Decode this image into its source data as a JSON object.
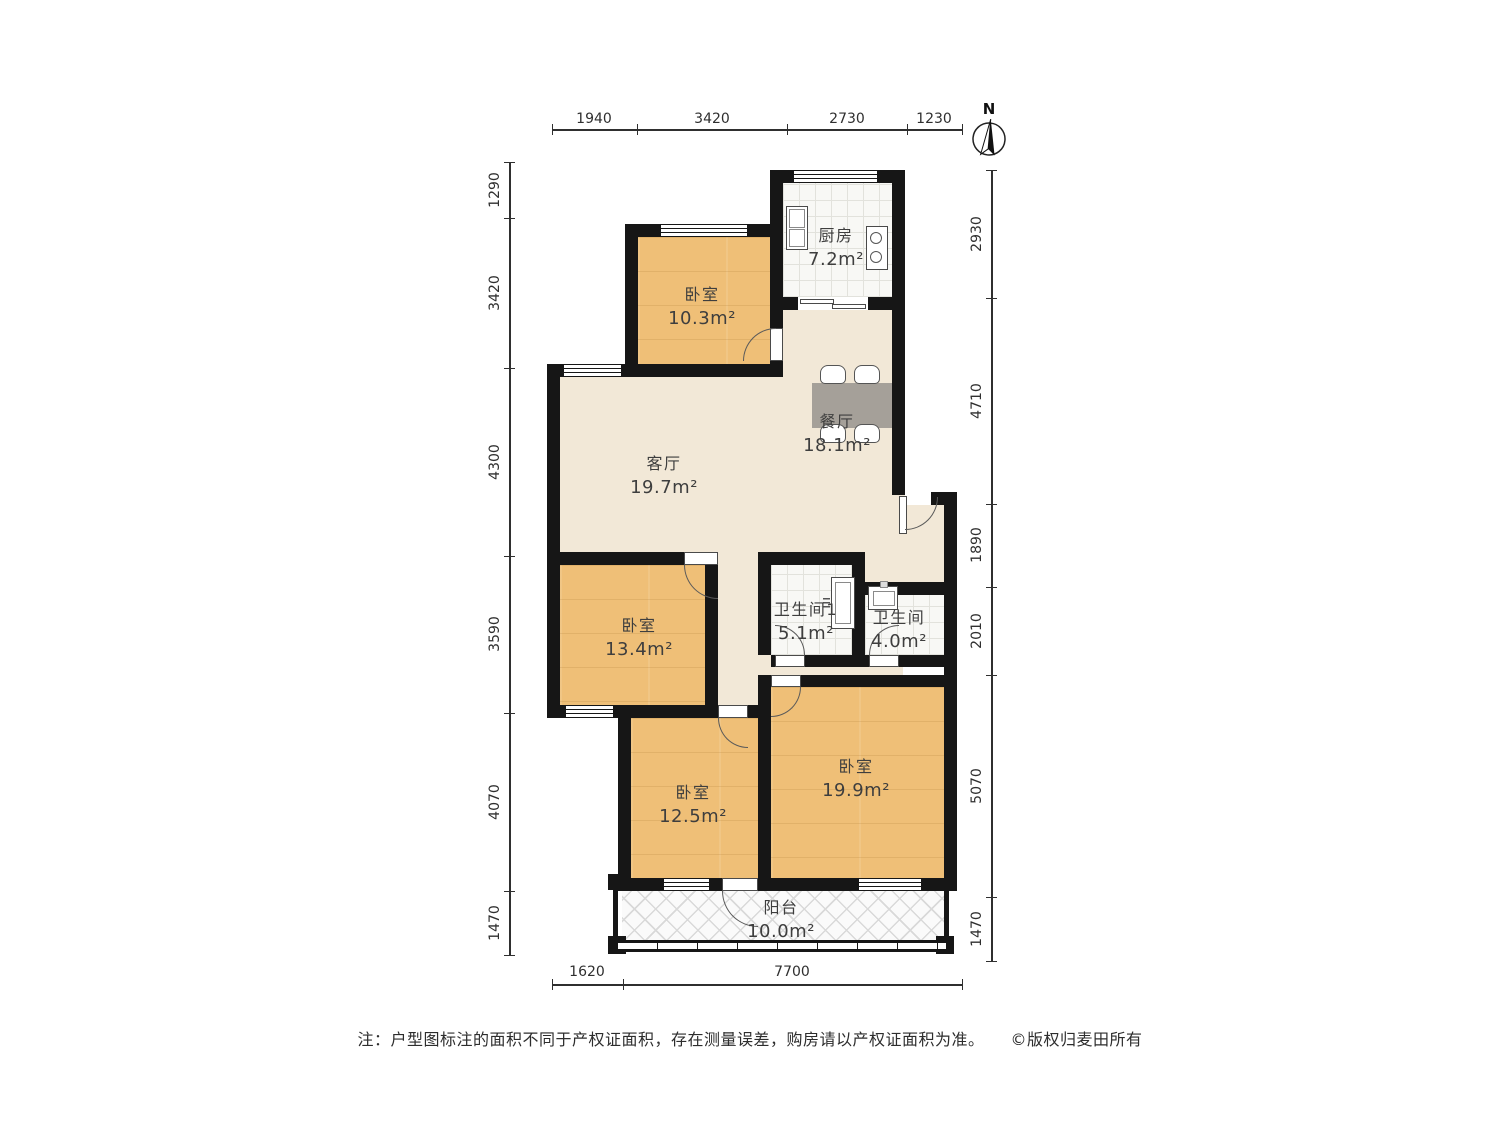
{
  "compass": {
    "label": "N"
  },
  "rooms": {
    "bedroom_top": {
      "name": "卧室",
      "area": "10.3m²"
    },
    "kitchen": {
      "name": "厨房",
      "area": "7.2m²"
    },
    "dining": {
      "name": "餐厅",
      "area": "18.1m²"
    },
    "living": {
      "name": "客厅",
      "area": "19.7m²"
    },
    "bedroom_mid": {
      "name": "卧室",
      "area": "13.4m²"
    },
    "bath1": {
      "name": "卫生间1",
      "area": "5.1m²"
    },
    "bath2": {
      "name": "卫生间",
      "area": "4.0m²"
    },
    "bedroom_bottom_left": {
      "name": "卧室",
      "area": "12.5m²"
    },
    "bedroom_bottom_right": {
      "name": "卧室",
      "area": "19.9m²"
    },
    "balcony": {
      "name": "阳台",
      "area": "10.0m²"
    }
  },
  "dimensions": {
    "top": [
      "1940",
      "3420",
      "2730",
      "1230"
    ],
    "left": [
      "1290",
      "3420",
      "4300",
      "3590",
      "4070",
      "1470"
    ],
    "right": [
      "2930",
      "4710",
      "1890",
      "2010",
      "5070",
      "1470"
    ],
    "bottom": [
      "1620",
      "7700"
    ]
  },
  "footer": {
    "note": "注：户型图标注的面积不同于产权证面积，存在测量误差，购房请以产权证面积为准。",
    "copyright": "©版权归麦田所有"
  },
  "colors": {
    "wall": "#161616",
    "wood_floor": "#efbf77",
    "beige_floor": "#f2e8d7",
    "tile_floor": "#f8f8f5",
    "table": "#a5a099"
  }
}
